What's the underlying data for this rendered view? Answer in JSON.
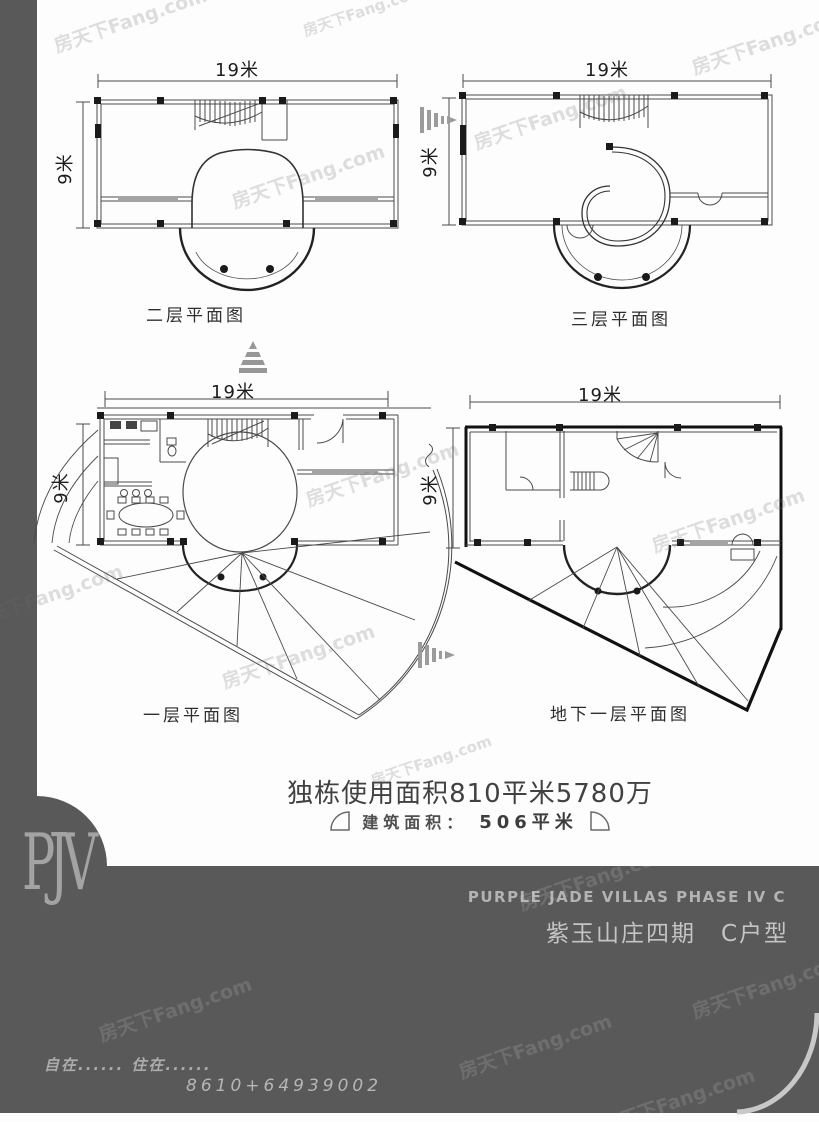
{
  "watermark": {
    "text": "房天下Fang.com"
  },
  "plans": [
    {
      "id": "second-floor",
      "title": "二层平面图",
      "dim_width": "19米",
      "dim_height": "9米"
    },
    {
      "id": "third-floor",
      "title": "三层平面图",
      "dim_width": "19米",
      "dim_height": "9米"
    },
    {
      "id": "first-floor",
      "title": "一层平面图",
      "dim_width": "19米",
      "dim_height": "9米"
    },
    {
      "id": "basement",
      "title": "地下一层平面图",
      "dim_width": "19米",
      "dim_height": "9米"
    }
  ],
  "summary": {
    "usable_area_line": "独栋使用面积810平米5780万",
    "built_area_label": "建筑面积：",
    "built_area_value": "506平米"
  },
  "footer": {
    "logo": "PJV",
    "title_en": "PURPLE JADE VILLAS PHASE IV C",
    "title_cn": "紫玉山庄四期　C户型",
    "slogan": "自在...... 住在......",
    "phone": "8610+64939002"
  },
  "colors": {
    "band": "#595959",
    "light_text": "#c4c4c4",
    "line": "#4a4a4a"
  }
}
